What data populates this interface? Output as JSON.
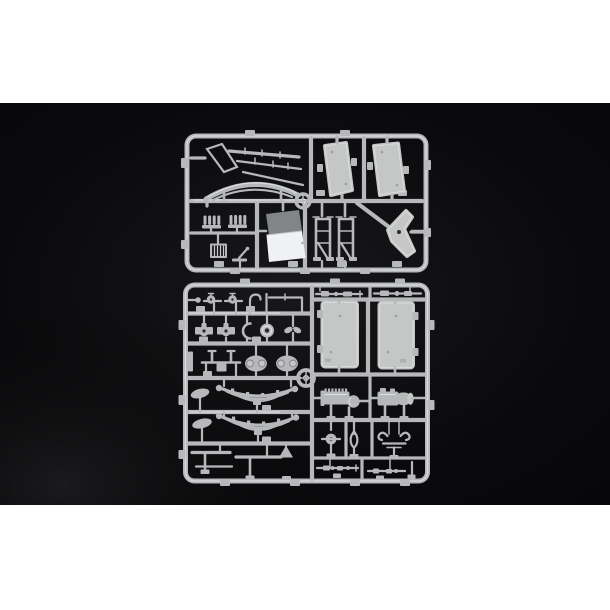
{
  "scene": {
    "description": "Product photograph of two light-gray injection-molded plastic model-kit sprues (parts frames) lying on a black backdrop, letterboxed by white bands at top and bottom. No text is visible in the photo.",
    "colors": {
      "matte_white": "#ffffff",
      "backdrop": "#0b0b0d",
      "backdrop_center": "#18181a",
      "plastic": "#b6b8ba",
      "plastic_highlight": "#e6e8ea",
      "plastic_shadow": "#87898c",
      "panel_fill": "#c5c6c6",
      "panel_edge": "#d9dada",
      "dark_detail": "#2b2b2d",
      "pin_mark": "#9b9da0",
      "mirror_dark": "#828588",
      "mirror_bright": "#eff1f3"
    }
  },
  "sprues": {
    "top": {
      "name": "sprue-A",
      "parts": [
        "windshield-frame-rails",
        "roof-bow-arc",
        "window-panel-left",
        "window-panel-right",
        "grille-comb-left",
        "grille-comb-right",
        "radiator-core",
        "shift-lever",
        "reflective-bent-plate",
        "door-frame-left",
        "door-frame-right",
        "arrow-shaped-panel",
        "center-ring-hub"
      ]
    },
    "bottom": {
      "name": "sprue-B",
      "parts": [
        "small-valve-fittings-row",
        "round-hub-covers-row",
        "axle-pad-ovals",
        "post-and-pad-assembly",
        "leaf-spring-upper",
        "leaf-spring-lower",
        "spring-paddles",
        "angled-rod-set",
        "funnel-piece",
        "door-panel-left",
        "door-panel-right",
        "tie-rod-linkages",
        "muffler-tank-left",
        "muffler-tank-right",
        "disc-bracket",
        "fork-bracket",
        "curled-hook-bracket",
        "chain-linkage-left",
        "chain-linkage-right",
        "center-ring-hub"
      ]
    }
  }
}
